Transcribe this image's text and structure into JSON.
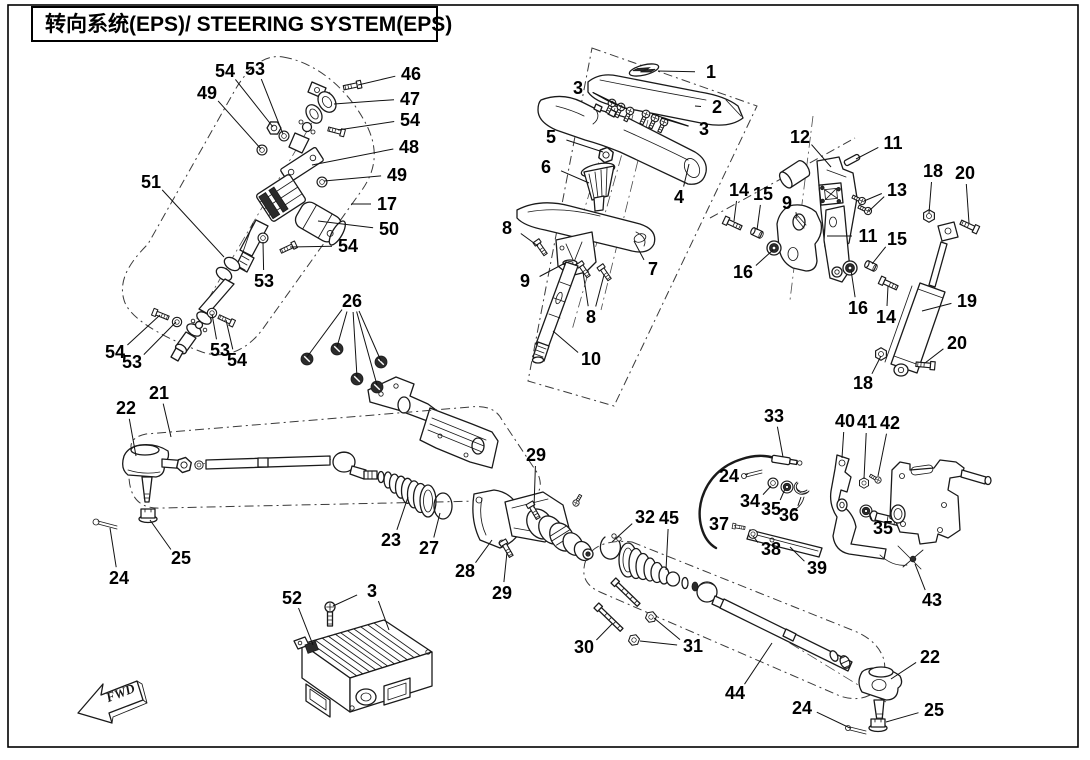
{
  "title": {
    "text": "转向系统(EPS)/ STEERING SYSTEM(EPS)"
  },
  "fwd_marker": {
    "label": "FWD"
  },
  "diagram": {
    "description": "Exploded parts diagram of steering system (EPS) with numbered part callouts",
    "callouts": [
      {
        "n": "54",
        "x": 225,
        "y": 71,
        "leaders": [
          [
            273,
            127
          ]
        ]
      },
      {
        "n": "53",
        "x": 255,
        "y": 69,
        "leaders": [
          [
            283,
            134
          ]
        ]
      },
      {
        "n": "49",
        "x": 207,
        "y": 93,
        "leaders": [
          [
            261,
            149
          ]
        ]
      },
      {
        "n": "46",
        "x": 411,
        "y": 74,
        "leaders": [
          [
            358,
            85
          ]
        ]
      },
      {
        "n": "47",
        "x": 410,
        "y": 99,
        "leaders": [
          [
            334,
            104
          ]
        ]
      },
      {
        "n": "54",
        "x": 410,
        "y": 120,
        "leaders": [
          [
            338,
            130
          ]
        ]
      },
      {
        "n": "48",
        "x": 409,
        "y": 147,
        "leaders": [
          [
            312,
            165
          ]
        ]
      },
      {
        "n": "49",
        "x": 397,
        "y": 175,
        "leaders": [
          [
            324,
            181
          ]
        ]
      },
      {
        "n": "51",
        "x": 151,
        "y": 182,
        "leaders": [
          [
            224,
            257
          ]
        ]
      },
      {
        "n": "17",
        "x": 387,
        "y": 204,
        "leaders": [
          [
            351,
            204
          ]
        ]
      },
      {
        "n": "50",
        "x": 389,
        "y": 229,
        "leaders": [
          [
            318,
            221
          ]
        ]
      },
      {
        "n": "54",
        "x": 348,
        "y": 246,
        "leaders": [
          [
            290,
            247
          ]
        ]
      },
      {
        "n": "53",
        "x": 264,
        "y": 281,
        "leaders": [
          [
            263,
            242
          ]
        ]
      },
      {
        "n": "54",
        "x": 115,
        "y": 352,
        "leaders": [
          [
            160,
            315
          ]
        ]
      },
      {
        "n": "53",
        "x": 132,
        "y": 362,
        "leaders": [
          [
            176,
            322
          ]
        ]
      },
      {
        "n": "53",
        "x": 220,
        "y": 350,
        "leaders": [
          [
            212,
            314
          ]
        ]
      },
      {
        "n": "54",
        "x": 237,
        "y": 360,
        "leaders": [
          [
            226,
            320
          ]
        ]
      },
      {
        "n": "26",
        "x": 352,
        "y": 301,
        "leaders": [
          [
            307,
            357
          ],
          [
            337,
            347
          ],
          [
            357,
            377
          ],
          [
            377,
            385
          ],
          [
            381,
            361
          ]
        ]
      },
      {
        "n": "1",
        "x": 711,
        "y": 72,
        "leaders": [
          [
            658,
            71
          ]
        ]
      },
      {
        "n": "3",
        "x": 578,
        "y": 88,
        "leaders": [
          [
            608,
            101
          ],
          [
            617,
            105
          ],
          [
            627,
            109
          ]
        ]
      },
      {
        "n": "2",
        "x": 717,
        "y": 107,
        "leaders": [
          [
            695,
            106
          ]
        ]
      },
      {
        "n": "3",
        "x": 704,
        "y": 129,
        "leaders": [
          [
            652,
            114
          ],
          [
            661,
            118
          ]
        ]
      },
      {
        "n": "5",
        "x": 551,
        "y": 137,
        "leaders": [
          [
            603,
            152
          ]
        ]
      },
      {
        "n": "6",
        "x": 546,
        "y": 167,
        "leaders": [
          [
            589,
            183
          ]
        ]
      },
      {
        "n": "4",
        "x": 679,
        "y": 197,
        "leaders": [
          [
            689,
            164
          ]
        ]
      },
      {
        "n": "8",
        "x": 507,
        "y": 228,
        "leaders": [
          [
            538,
            246
          ]
        ]
      },
      {
        "n": "9",
        "x": 525,
        "y": 281,
        "leaders": [
          [
            567,
            262
          ]
        ]
      },
      {
        "n": "7",
        "x": 653,
        "y": 269,
        "leaders": [
          [
            634,
            241
          ]
        ]
      },
      {
        "n": "8",
        "x": 591,
        "y": 317,
        "leaders": [
          [
            583,
            272
          ],
          [
            604,
            275
          ]
        ]
      },
      {
        "n": "10",
        "x": 591,
        "y": 359,
        "leaders": [
          [
            553,
            331
          ]
        ]
      },
      {
        "n": "12",
        "x": 800,
        "y": 137,
        "leaders": [
          [
            831,
            167
          ]
        ]
      },
      {
        "n": "11",
        "x": 893,
        "y": 143,
        "leaders": [
          [
            856,
            159
          ]
        ]
      },
      {
        "n": "13",
        "x": 897,
        "y": 190,
        "leaders": [
          [
            864,
            201
          ],
          [
            869,
            211
          ]
        ]
      },
      {
        "n": "14",
        "x": 739,
        "y": 190,
        "leaders": [
          [
            734,
            221
          ]
        ]
      },
      {
        "n": "15",
        "x": 763,
        "y": 194,
        "leaders": [
          [
            757,
            230
          ]
        ]
      },
      {
        "n": "9",
        "x": 787,
        "y": 203,
        "leaders": [
          [
            797,
            218
          ]
        ]
      },
      {
        "n": "18",
        "x": 933,
        "y": 171,
        "leaders": [
          [
            929,
            213
          ]
        ]
      },
      {
        "n": "20",
        "x": 965,
        "y": 173,
        "leaders": [
          [
            969,
            223
          ]
        ]
      },
      {
        "n": "11",
        "x": 868,
        "y": 236,
        "leaders": [
          [
            827,
            236
          ]
        ]
      },
      {
        "n": "15",
        "x": 897,
        "y": 239,
        "leaders": [
          [
            872,
            264
          ]
        ]
      },
      {
        "n": "16",
        "x": 743,
        "y": 272,
        "leaders": [
          [
            773,
            250
          ]
        ]
      },
      {
        "n": "16",
        "x": 858,
        "y": 308,
        "leaders": [
          [
            851,
            270
          ]
        ]
      },
      {
        "n": "14",
        "x": 886,
        "y": 317,
        "leaders": [
          [
            888,
            286
          ]
        ]
      },
      {
        "n": "19",
        "x": 967,
        "y": 301,
        "leaders": [
          [
            922,
            311
          ]
        ]
      },
      {
        "n": "20",
        "x": 957,
        "y": 343,
        "leaders": [
          [
            925,
            363
          ]
        ]
      },
      {
        "n": "18",
        "x": 863,
        "y": 383,
        "leaders": [
          [
            881,
            356
          ]
        ]
      },
      {
        "n": "22",
        "x": 126,
        "y": 408,
        "leaders": [
          [
            136,
            456
          ]
        ]
      },
      {
        "n": "21",
        "x": 159,
        "y": 393,
        "leaders": [
          [
            171,
            437
          ]
        ]
      },
      {
        "n": "25",
        "x": 181,
        "y": 558,
        "leaders": [
          [
            150,
            520
          ]
        ]
      },
      {
        "n": "24",
        "x": 119,
        "y": 578,
        "leaders": [
          [
            110,
            528
          ]
        ]
      },
      {
        "n": "23",
        "x": 391,
        "y": 540,
        "leaders": [
          [
            408,
            497
          ]
        ]
      },
      {
        "n": "27",
        "x": 429,
        "y": 548,
        "leaders": [
          [
            440,
            513
          ]
        ]
      },
      {
        "n": "28",
        "x": 465,
        "y": 571,
        "leaders": [
          [
            492,
            540
          ]
        ]
      },
      {
        "n": "29",
        "x": 536,
        "y": 455,
        "leaders": [
          [
            534,
            508
          ]
        ]
      },
      {
        "n": "29",
        "x": 502,
        "y": 593,
        "leaders": [
          [
            507,
            552
          ]
        ]
      },
      {
        "n": "32",
        "x": 645,
        "y": 517,
        "leaders": [
          [
            612,
            542
          ]
        ]
      },
      {
        "n": "45",
        "x": 669,
        "y": 518,
        "leaders": [
          [
            666,
            570
          ]
        ]
      },
      {
        "n": "30",
        "x": 584,
        "y": 647,
        "leaders": [
          [
            612,
            624
          ]
        ]
      },
      {
        "n": "31",
        "x": 693,
        "y": 646,
        "leaders": [
          [
            654,
            618
          ],
          [
            640,
            641
          ]
        ]
      },
      {
        "n": "52",
        "x": 292,
        "y": 598,
        "leaders": [
          [
            313,
            645
          ]
        ]
      },
      {
        "n": "3",
        "x": 372,
        "y": 591,
        "leaders": [
          [
            333,
            606
          ],
          [
            389,
            630
          ]
        ]
      },
      {
        "n": "44",
        "x": 735,
        "y": 693,
        "leaders": [
          [
            772,
            643
          ]
        ]
      },
      {
        "n": "22",
        "x": 930,
        "y": 657,
        "leaders": [
          [
            891,
            679
          ]
        ]
      },
      {
        "n": "24",
        "x": 802,
        "y": 708,
        "leaders": [
          [
            850,
            728
          ]
        ]
      },
      {
        "n": "25",
        "x": 934,
        "y": 710,
        "leaders": [
          [
            886,
            722
          ]
        ]
      },
      {
        "n": "33",
        "x": 774,
        "y": 416,
        "leaders": [
          [
            783,
            457
          ]
        ]
      },
      {
        "n": "40",
        "x": 845,
        "y": 421,
        "leaders": [
          [
            842,
            458
          ]
        ]
      },
      {
        "n": "41",
        "x": 867,
        "y": 422,
        "leaders": [
          [
            864,
            479
          ]
        ]
      },
      {
        "n": "42",
        "x": 890,
        "y": 423,
        "leaders": [
          [
            878,
            476
          ]
        ]
      },
      {
        "n": "24",
        "x": 729,
        "y": 476,
        "leaders": [
          [
            748,
            474
          ]
        ]
      },
      {
        "n": "34",
        "x": 750,
        "y": 501,
        "leaders": [
          [
            771,
            486
          ]
        ]
      },
      {
        "n": "35",
        "x": 771,
        "y": 509,
        "leaders": [
          [
            785,
            489
          ]
        ]
      },
      {
        "n": "36",
        "x": 789,
        "y": 515,
        "leaders": [
          [
            801,
            497
          ]
        ]
      },
      {
        "n": "37",
        "x": 719,
        "y": 524,
        "leaders": [
          [
            734,
            526
          ]
        ]
      },
      {
        "n": "38",
        "x": 771,
        "y": 549,
        "leaders": [
          [
            753,
            536
          ]
        ]
      },
      {
        "n": "39",
        "x": 817,
        "y": 568,
        "leaders": [
          [
            790,
            547
          ]
        ]
      },
      {
        "n": "35",
        "x": 883,
        "y": 528,
        "leaders": [
          [
            869,
            513
          ]
        ]
      },
      {
        "n": "43",
        "x": 932,
        "y": 600,
        "leaders": [
          [
            915,
            564
          ]
        ]
      }
    ]
  }
}
